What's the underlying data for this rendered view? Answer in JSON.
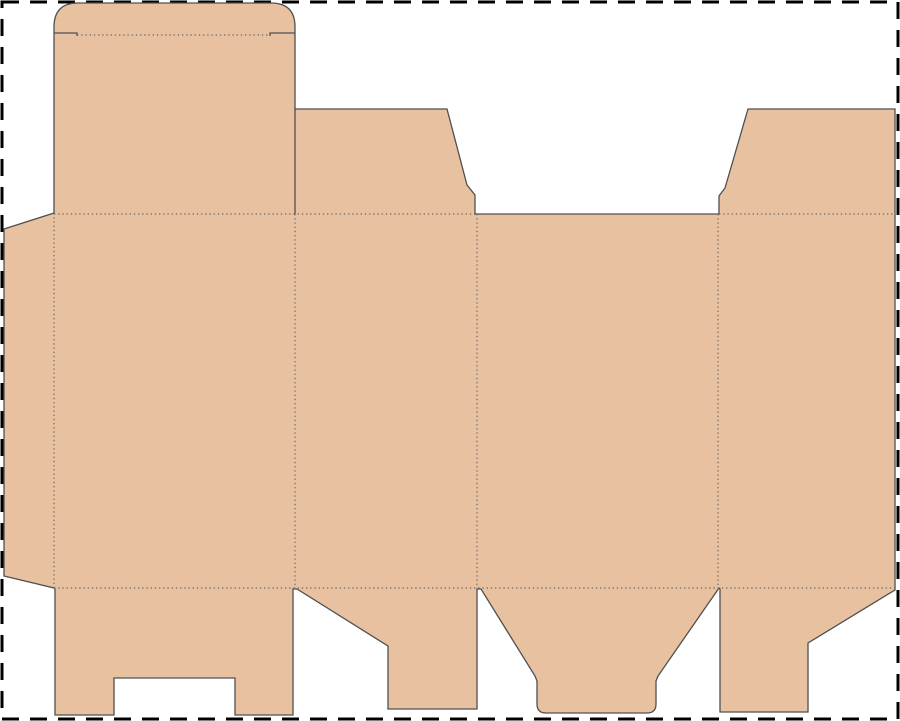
{
  "canvas": {
    "width": 900,
    "height": 721,
    "background": "#ffffff"
  },
  "colors": {
    "board_fill": "#e8c2a0",
    "cut_line": "#4f4f4f",
    "fold_line": "#6f6a66",
    "artboard_border": "#000000"
  },
  "strokes": {
    "cut_width": 1.3,
    "fold_width": 1.2,
    "fold_dash": "1.4 2.8",
    "border_width": 3,
    "border_dash": "17 11"
  },
  "paths": {
    "outline": "M 78 3 L 271 3 Q 295 3 295 27 L 295 109 L 447 109 L 467 185 L 475 195 L 475 214 L 719 214 L 719 196 L 725 188 L 748 109 L 895 109 L 895 590 L 808 643 L 808 712 L 720 712 L 720 589 L 719 588 L 658 676 L 656 681 L 656 704 Q 656 713 647 713 L 546 713 Q 537 713 537 704 L 537 681 L 535 676 L 481 589 L 477 589 L 477 709 L 388 709 L 388 646 L 297 589 L 293 589 L 293 715 L 235 715 L 235 678 L 114 678 L 114 715 L 55 715 L 55 589 L 54 588 L 4 576 L 4 229 L 54 213 L 54 27 Q 54 3 78 3 Z",
    "cuts": [
      "M 54 33 L 77 33 L 77 36",
      "M 295 33 L 270 33 L 270 36",
      "M 295 109 L 295 214"
    ],
    "folds": [
      "M 77 35 L 270 35",
      "M 54 214 L 475 214",
      "M 719 214 L 895 214",
      "M 54 588 L 895 588",
      "M 54 213 L 54 588",
      "M 295 214 L 295 588",
      "M 477 214 L 477 588",
      "M 718 214 L 718 588"
    ],
    "border_rect": {
      "x": 2,
      "y": 2,
      "w": 896,
      "h": 717
    }
  }
}
